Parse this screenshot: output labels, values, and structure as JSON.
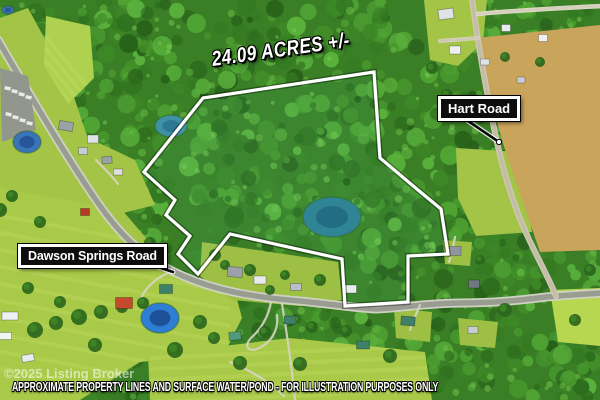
{
  "overlay": {
    "acreage": "24.09 ACRES +/-",
    "hart_road": "Hart Road",
    "dawson_road": "Dawson Springs Road",
    "watermark": "©2025 Listing Broker",
    "disclaimer": "APPROXIMATE PROPERTY LINES AND SURFACE WATER/POND - FOR ILLUSTRATION PURPOSES ONLY"
  },
  "colors": {
    "boundary": "#ffffff",
    "label_bg": "#0d0d0d",
    "label_border": "#ffffff",
    "label_text": "#ffffff",
    "forest_base": "#3a7f25",
    "lawn": "#a8ca48",
    "tan_field": "#c9a45b",
    "road_gray": "#999c90",
    "pond_teal": "#2c7e92",
    "pond_blue": "#2e7fd4"
  },
  "map": {
    "width": 600,
    "height": 400,
    "boundary_points": "203,98 374,72 380,158 418,190 441,209 448,254 408,256 408,302 345,306 342,259 230,234 198,274 178,254 190,236 166,215 175,200 144,172",
    "canopy_palette": [
      "#27601a",
      "#2e6e1e",
      "#357a22",
      "#3d8827",
      "#46962d",
      "#50a434",
      "#5ab13c"
    ],
    "canopy_highlight": [
      "#6fbf49",
      "#7acb52"
    ],
    "patches": [
      {
        "name": "nw-corridor",
        "pts": "0,18 28,8 70,85 105,190 175,272 150,292 70,225 0,190",
        "fill": "#a3c447"
      },
      {
        "name": "nw-meadow",
        "pts": "46,16 90,26 94,78 68,104 44,66",
        "fill": "#aed14f",
        "stripes": {
          "n": 4,
          "x1": 40,
          "y1": 30,
          "dx": 50,
          "dy": 60,
          "step": 12,
          "color": "#c2dd66",
          "w": 4,
          "op": 0.35
        }
      },
      {
        "name": "left-lawn",
        "pts": "40,115 135,160 155,205 115,215 48,160",
        "fill": "#a3c447"
      },
      {
        "name": "sw-lawn",
        "pts": "0,188 95,205 170,275 235,292 242,318 225,352 140,362 80,400 0,400",
        "fill": "#a8ca48",
        "stripes": {
          "n": 10,
          "x1": -20,
          "y1": 212,
          "dx": 250,
          "dy": 46,
          "step": 17,
          "color": "#c2dd66",
          "w": 4,
          "op": 0.35
        }
      },
      {
        "name": "wedge-lawn",
        "pts": "202,242 338,262 342,300 300,306 232,300 200,276",
        "fill": "#9dbf44"
      },
      {
        "name": "s-field",
        "pts": "148,355 290,338 425,352 432,400 150,400",
        "fill": "#a8ca48",
        "stripes": {
          "n": 5,
          "x1": 150,
          "y1": 358,
          "dx": 280,
          "dy": -12,
          "step": 11,
          "color": "#c2dd66",
          "w": 4,
          "op": 0.35
        }
      },
      {
        "name": "ne-lawn",
        "pts": "424,0 487,0 483,42 458,66 430,60",
        "fill": "#a3c447"
      },
      {
        "name": "hart-lawn",
        "pts": "456,148 520,152 532,232 476,236 458,198",
        "fill": "#a3c447"
      },
      {
        "name": "se-bright-field",
        "pts": "550,290 600,288 600,346 558,342",
        "fill": "#b6d74f"
      },
      {
        "name": "house-lawn-1",
        "pts": "443,240 472,242 470,266 445,264",
        "fill": "#9dbf44"
      },
      {
        "name": "house-lawn-2",
        "pts": "458,318 498,322 495,348 460,345",
        "fill": "#9dbf44"
      },
      {
        "name": "house-lawn-3",
        "pts": "394,308 432,312 430,342 396,338",
        "fill": "#9dbf44"
      },
      {
        "name": "tan-field",
        "pts": "477,38 600,25 600,250 540,252 505,150 488,90",
        "fill": "#c9a45b",
        "stripes": {
          "n": 16,
          "x1": 470,
          "y1": 30,
          "dx": 50,
          "dy": 215,
          "step": 8,
          "color": "#b48a3e",
          "w": 3,
          "op": 0.4
        }
      }
    ],
    "roads": [
      {
        "name": "dawson-springs-road",
        "d": "M -2,40 C 30,95 65,155 98,203 C 125,242 150,262 183,276 C 215,290 250,297 300,301 C 330,304 356,308 376,309 C 400,308 430,303 460,303 C 495,303 522,300 546,297 C 566,295 586,294 602,293",
        "casing": "#cfd2c2",
        "wc": 9,
        "color": "#999c90",
        "w": 5.5
      },
      {
        "name": "hart-road",
        "d": "M 472,-2 C 476,30 483,75 496,138 C 503,170 512,200 523,226 C 534,252 547,274 556,296",
        "casing": "#cfc9b4",
        "wc": 6,
        "color": "#c3bda6",
        "w": 3.5
      },
      {
        "name": "spur-road",
        "d": "M 440,41 L 478,38",
        "casing": "#d8d3c2",
        "wc": 4,
        "color": "#cfc9b4",
        "w": 2.5
      },
      {
        "name": "top-road",
        "d": "M 478,14 C 520,10 560,8 602,6",
        "casing": "#e0dccc",
        "wc": 4.5,
        "color": "#d5d0bc",
        "w": 3
      }
    ],
    "driveways": [
      {
        "d": "M 271,302 C 268,318 260,330 251,338 C 244,345 247,352 257,349 C 270,344 279,331 277,315"
      },
      {
        "d": "M 282,304 C 288,340 292,370 295,400"
      },
      {
        "d": "M 420,305 C 416,315 412,322 410,330"
      },
      {
        "d": "M 230,362 C 250,370 268,381 284,396"
      },
      {
        "d": "M 168,273 C 152,280 142,292 139,304"
      },
      {
        "d": "M 455,237 C 453,248 451,256 449,262"
      },
      {
        "d": "M 96,160 C 104,168 112,176 118,184"
      }
    ],
    "parking": {
      "pts": "0,68 28,76 36,130 2,142",
      "fill": "#93968c",
      "cars": [
        [
          5,
          86
        ],
        [
          12,
          89
        ],
        [
          19,
          92
        ],
        [
          26,
          95
        ],
        [
          6,
          112
        ],
        [
          13,
          115
        ],
        [
          20,
          118
        ],
        [
          27,
          121
        ]
      ]
    },
    "ponds": [
      {
        "name": "property-pond",
        "cx": 332,
        "cy": 217,
        "rx": 29,
        "ry": 20,
        "fill": "#2c7e92",
        "inner": "#1c5e7c"
      },
      {
        "name": "west-pond",
        "cx": 171,
        "cy": 126,
        "rx": 16,
        "ry": 11,
        "fill": "#3f92a5",
        "inner": "#2a7490"
      },
      {
        "name": "parking-pond",
        "cx": 27,
        "cy": 142,
        "rx": 14,
        "ry": 11,
        "fill": "#3a74b8",
        "inner": "#235093"
      },
      {
        "name": "sw-pond",
        "cx": 160,
        "cy": 318,
        "rx": 19,
        "ry": 15,
        "fill": "#2e7fd4",
        "inner": "#1a4a8f"
      },
      {
        "name": "corner-pool",
        "cx": 8,
        "cy": 10,
        "rx": 6,
        "ry": 4,
        "fill": "#3a74b8",
        "inner": "#235093"
      }
    ],
    "houses": [
      [
        446,
        14,
        15,
        10,
        -8,
        "#dfe3e6"
      ],
      [
        455,
        50,
        11,
        8,
        0,
        "#eef0f2"
      ],
      [
        506,
        28,
        9,
        7,
        0,
        "#e8ebee"
      ],
      [
        543,
        38,
        9,
        7,
        0,
        "#eef0f2"
      ],
      [
        66,
        126,
        14,
        9,
        10,
        "#9aa1a8"
      ],
      [
        93,
        139,
        11,
        8,
        0,
        "#dfe3e6"
      ],
      [
        83,
        151,
        9,
        7,
        0,
        "#c7ccd2"
      ],
      [
        107,
        160,
        10,
        7,
        -5,
        "#9aa1a8"
      ],
      [
        118,
        172,
        9,
        6,
        0,
        "#dde0e4"
      ],
      [
        85,
        212,
        9,
        7,
        0,
        "#b53a28"
      ],
      [
        235,
        272,
        15,
        10,
        5,
        "#9aa1a8"
      ],
      [
        260,
        280,
        12,
        8,
        0,
        "#e8ebee"
      ],
      [
        296,
        287,
        11,
        7,
        0,
        "#b8bec6"
      ],
      [
        350,
        289,
        13,
        8,
        0,
        "#eef0f2"
      ],
      [
        124,
        303,
        17,
        11,
        0,
        "#c44a2e"
      ],
      [
        166,
        289,
        13,
        9,
        0,
        "#3e8068"
      ],
      [
        10,
        316,
        16,
        8,
        0,
        "#eef0f2"
      ],
      [
        5,
        336,
        13,
        7,
        0,
        "#f2f4f6"
      ],
      [
        28,
        358,
        12,
        7,
        -10,
        "#e8ebee"
      ],
      [
        408,
        321,
        14,
        9,
        5,
        "#3e8068"
      ],
      [
        474,
        284,
        11,
        8,
        0,
        "#707880"
      ],
      [
        473,
        330,
        10,
        7,
        0,
        "#c7ccd2"
      ],
      [
        455,
        251,
        12,
        9,
        0,
        "#8f969e"
      ],
      [
        290,
        320,
        12,
        8,
        0,
        "#3e8068"
      ],
      [
        235,
        336,
        12,
        8,
        -5,
        "#4e9a7a"
      ],
      [
        363,
        345,
        13,
        8,
        0,
        "#3e8068"
      ],
      [
        485,
        62,
        9,
        6,
        0,
        "#dfe3e6"
      ],
      [
        521,
        80,
        8,
        6,
        0,
        "#c7ccd2"
      ]
    ],
    "trees": [
      [
        35,
        330,
        8
      ],
      [
        56,
        323,
        7
      ],
      [
        79,
        317,
        8
      ],
      [
        101,
        312,
        7
      ],
      [
        122,
        307,
        6
      ],
      [
        143,
        303,
        6
      ],
      [
        60,
        258,
        7
      ],
      [
        40,
        222,
        6
      ],
      [
        150,
        243,
        6
      ],
      [
        175,
        350,
        8
      ],
      [
        200,
        322,
        7
      ],
      [
        214,
        338,
        6
      ],
      [
        240,
        363,
        7
      ],
      [
        265,
        332,
        6
      ],
      [
        300,
        364,
        7
      ],
      [
        312,
        327,
        6
      ],
      [
        346,
        331,
        6
      ],
      [
        390,
        356,
        7
      ],
      [
        60,
        302,
        6
      ],
      [
        95,
        345,
        7
      ],
      [
        28,
        288,
        6
      ],
      [
        432,
        68,
        6
      ],
      [
        447,
        95,
        6
      ],
      [
        505,
        57,
        5
      ],
      [
        540,
        62,
        5
      ],
      [
        590,
        270,
        6
      ],
      [
        575,
        320,
        6
      ],
      [
        505,
        310,
        7
      ],
      [
        480,
        260,
        5
      ],
      [
        0,
        210,
        7
      ],
      [
        12,
        196,
        6
      ],
      [
        215,
        255,
        6
      ],
      [
        225,
        265,
        5
      ],
      [
        250,
        270,
        6
      ],
      [
        285,
        275,
        5
      ],
      [
        320,
        280,
        6
      ],
      [
        270,
        290,
        5
      ]
    ],
    "leaders": [
      {
        "name": "hart-road-leader",
        "x1": 468,
        "y1": 121,
        "x2": 499,
        "y2": 142,
        "dot": true
      },
      {
        "name": "dawson-road-leader",
        "x1": 146,
        "y1": 263,
        "x2": 173,
        "y2": 272,
        "dot": false
      }
    ]
  }
}
